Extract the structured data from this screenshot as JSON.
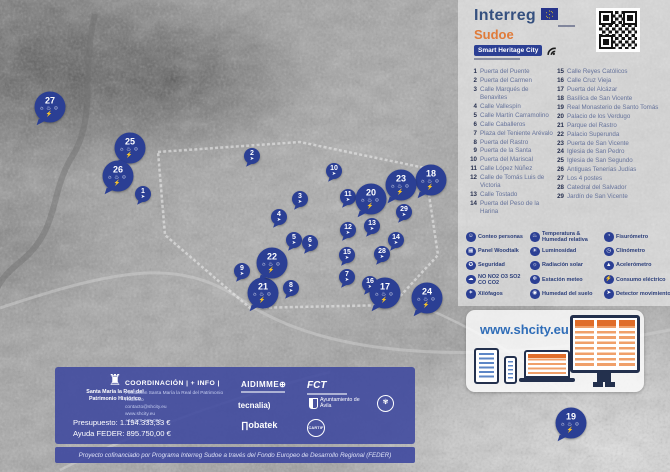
{
  "header": {
    "interreg": "Interreg",
    "sudoe": "Sudoe",
    "smart_heritage": "Smart Heritage City"
  },
  "poi_list": {
    "column1": [
      {
        "num": 1,
        "label": "Puerta del Puente"
      },
      {
        "num": 2,
        "label": "Puerta del Carmen"
      },
      {
        "num": 3,
        "label": "Calle Marqués de Benavites"
      },
      {
        "num": 4,
        "label": "Calle Vallespín"
      },
      {
        "num": 5,
        "label": "Calle Martín Carramolino"
      },
      {
        "num": 6,
        "label": "Calle Caballeros"
      },
      {
        "num": 7,
        "label": "Plaza del Teniente Arévalo"
      },
      {
        "num": 8,
        "label": "Puerta del Rastro"
      },
      {
        "num": 9,
        "label": "Puerta de la Santa"
      },
      {
        "num": 10,
        "label": "Puerta del Mariscal"
      },
      {
        "num": 11,
        "label": "Calle López Núñez"
      },
      {
        "num": 12,
        "label": "Calle de Tomás Luis de Victoria"
      },
      {
        "num": 13,
        "label": "Calle Tostado"
      },
      {
        "num": 14,
        "label": "Puerta del Peso de la Harina"
      }
    ],
    "column2": [
      {
        "num": 15,
        "label": "Calle Reyes Católicos"
      },
      {
        "num": 16,
        "label": "Calle Cruz Vieja"
      },
      {
        "num": 17,
        "label": "Puerta del Alcázar"
      },
      {
        "num": 18,
        "label": "Basílica de San Vicente"
      },
      {
        "num": 19,
        "label": "Real Monasterio de Santo Tomás"
      },
      {
        "num": 20,
        "label": "Palacio de los Verdugo"
      },
      {
        "num": 21,
        "label": "Parque del Rastro"
      },
      {
        "num": 22,
        "label": "Palacio Superunda"
      },
      {
        "num": 23,
        "label": "Puerta de San Vicente"
      },
      {
        "num": 24,
        "label": "Iglesia de San Pedro"
      },
      {
        "num": 25,
        "label": "Iglesia de San Segundo"
      },
      {
        "num": 26,
        "label": "Antiguas Tenerías Judías"
      },
      {
        "num": 27,
        "label": "Los 4 postes"
      },
      {
        "num": 28,
        "label": "Catedral del Salvador"
      },
      {
        "num": 29,
        "label": "Jardín de San Vicente"
      }
    ]
  },
  "sensors": {
    "columns": [
      [
        {
          "id": "conteo-personas",
          "glyph": "☺",
          "label": "Conteo personas"
        },
        {
          "id": "panel-woodtalk",
          "glyph": "▦",
          "label": "Panel Woodtalk"
        },
        {
          "id": "seguridad",
          "glyph": "✪",
          "label": "Seguridad"
        },
        {
          "id": "gases",
          "glyph": "☁",
          "label": "NO NO2 O3 SO2 CO CO2"
        },
        {
          "id": "xilofagos",
          "glyph": "✶",
          "label": "Xilófagos"
        }
      ],
      [
        {
          "id": "temperatura-humedad",
          "glyph": "♨",
          "label": "Temperatura & Humedad relativa"
        },
        {
          "id": "luminosidad",
          "glyph": "☀",
          "label": "Luminosidad"
        },
        {
          "id": "radiacion-solar",
          "glyph": "☼",
          "label": "Radiación solar"
        },
        {
          "id": "estacion-meteo",
          "glyph": "❄",
          "label": "Estación meteo"
        },
        {
          "id": "humedad-suelo",
          "glyph": "◉",
          "label": "Humedad del suelo"
        }
      ],
      [
        {
          "id": "fisurometro",
          "glyph": "◔",
          "label": "Fisurómetro"
        },
        {
          "id": "clinometro",
          "glyph": "◷",
          "label": "Clinómetro"
        },
        {
          "id": "acelerometro",
          "glyph": "▲",
          "label": "Acelerómetro"
        },
        {
          "id": "consumo-electrico",
          "glyph": "⚡",
          "label": "Consumo eléctrico"
        },
        {
          "id": "detector-movimiento",
          "glyph": "➤",
          "label": "Detector movimiento"
        }
      ]
    ]
  },
  "shcity": {
    "url": "www.shcity.eu"
  },
  "map": {
    "small_marker_glyph": "➤",
    "large_marker_glyphs": "☼♨☺⚡",
    "markers": [
      {
        "n": 1,
        "x": 143,
        "y": 194,
        "size": "s"
      },
      {
        "n": 2,
        "x": 252,
        "y": 156,
        "size": "s"
      },
      {
        "n": 3,
        "x": 300,
        "y": 199,
        "size": "s"
      },
      {
        "n": 4,
        "x": 279,
        "y": 217,
        "size": "s"
      },
      {
        "n": 5,
        "x": 294,
        "y": 240,
        "size": "s"
      },
      {
        "n": 6,
        "x": 310,
        "y": 243,
        "size": "s"
      },
      {
        "n": 7,
        "x": 347,
        "y": 277,
        "size": "s"
      },
      {
        "n": 8,
        "x": 291,
        "y": 288,
        "size": "s"
      },
      {
        "n": 9,
        "x": 242,
        "y": 271,
        "size": "s"
      },
      {
        "n": 10,
        "x": 334,
        "y": 171,
        "size": "s"
      },
      {
        "n": 11,
        "x": 348,
        "y": 197,
        "size": "s"
      },
      {
        "n": 12,
        "x": 348,
        "y": 230,
        "size": "s"
      },
      {
        "n": 13,
        "x": 372,
        "y": 226,
        "size": "s"
      },
      {
        "n": 14,
        "x": 396,
        "y": 240,
        "size": "s"
      },
      {
        "n": 15,
        "x": 347,
        "y": 255,
        "size": "s"
      },
      {
        "n": 16,
        "x": 370,
        "y": 284,
        "size": "s"
      },
      {
        "n": 17,
        "x": 385,
        "y": 293,
        "size": "l"
      },
      {
        "n": 18,
        "x": 431,
        "y": 180,
        "size": "l"
      },
      {
        "n": 19,
        "x": 571,
        "y": 423,
        "size": "l"
      },
      {
        "n": 20,
        "x": 371,
        "y": 199,
        "size": "l"
      },
      {
        "n": 21,
        "x": 263,
        "y": 293,
        "size": "l"
      },
      {
        "n": 22,
        "x": 272,
        "y": 263,
        "size": "l"
      },
      {
        "n": 23,
        "x": 401,
        "y": 185,
        "size": "l"
      },
      {
        "n": 24,
        "x": 427,
        "y": 298,
        "size": "l"
      },
      {
        "n": 25,
        "x": 130,
        "y": 148,
        "size": "l"
      },
      {
        "n": 26,
        "x": 118,
        "y": 176,
        "size": "l"
      },
      {
        "n": 27,
        "x": 50,
        "y": 107,
        "size": "l"
      },
      {
        "n": 28,
        "x": 382,
        "y": 254,
        "size": "s"
      },
      {
        "n": 29,
        "x": 404,
        "y": 212,
        "size": "s"
      }
    ]
  },
  "footer": {
    "foundation_name": "Santa María la Real del Patrimonio Histórico",
    "coordination_title": "COORDINACIÓN | + INFO |",
    "coordination_lines": [
      "Fundación Santa María la Real del Patrimonio Histórico",
      "contacto@shcity.eu",
      "www.shcity.eu",
      "+34 979 125 000"
    ],
    "budget": "Presupuesto: 1.194.333,33 €",
    "feder": "Ayuda FEDER: 895.750,00 €",
    "partners": {
      "aidimme": "AIDIMME⊕",
      "fct": "FCT",
      "tecnalia": "tecnalia)",
      "ayto": "Ayuntamiento de Ávila",
      "nobatek": "∏obatek",
      "cartif": "CARTIF"
    },
    "cofinance": "Proyecto cofinanciado por Programa Interreg Sudoe a través del Fondo Europeo de Desarrollo Regional (FEDER)"
  }
}
